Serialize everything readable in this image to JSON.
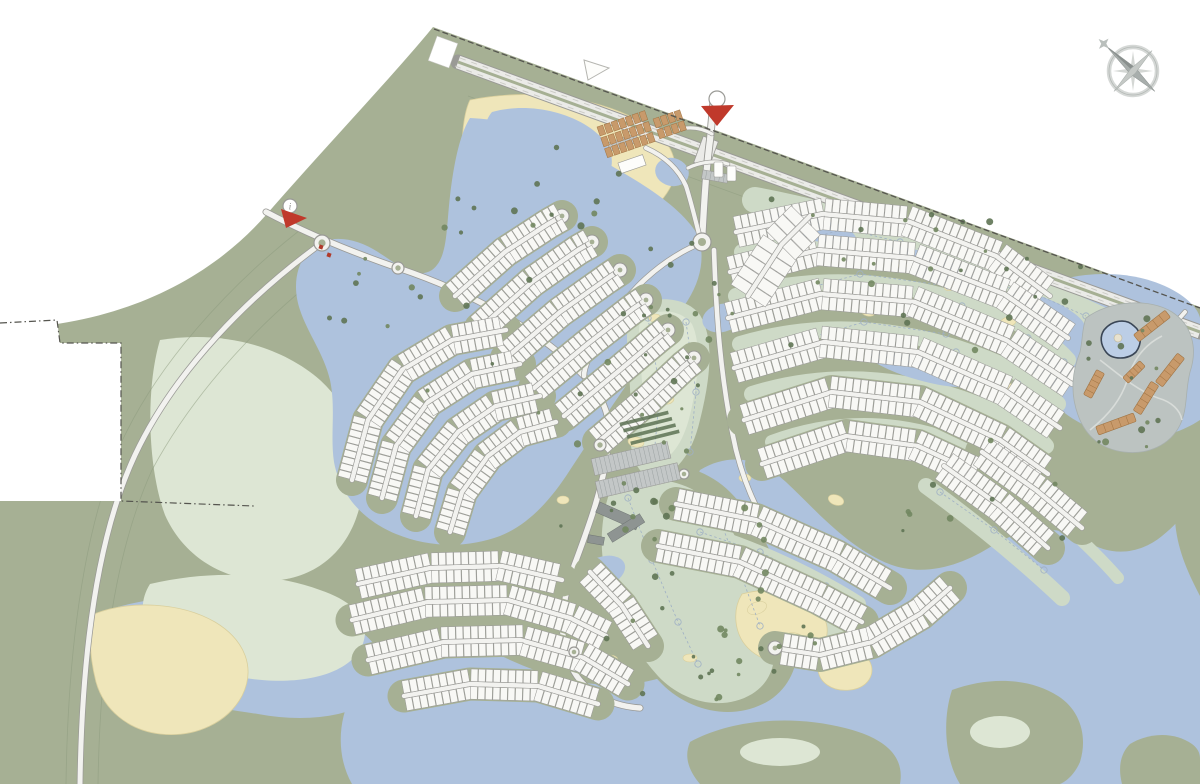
{
  "markers": {
    "info_label": "i"
  },
  "colors": {
    "background": "#ffffff",
    "land": "#a6b094",
    "land_contour": "#8d9a7e",
    "pale_green": "#cedac7",
    "pale_green_light": "#dde6d4",
    "water": "#aec2dd",
    "water_light": "#bccee6",
    "sand": "#efe6ba",
    "sand_stroke": "#d9cf9d",
    "plot_fill": "#f8f8f5",
    "plot_stroke": "#9b9b98",
    "road_fill": "#f2f2ef",
    "road_casing": "#9a9a96",
    "highway_fill": "#ebebe8",
    "building_orange": "#c89a6b",
    "building_orange_dark": "#a07342",
    "building_gray": "#8e9492",
    "parking_gray": "#c3c7c7",
    "resort_ground": "#bcc3c1",
    "tree_dark": "#5f7454",
    "tree_mid": "#728760",
    "marker_red": "#c0392b",
    "compass_gray": "#b3b8b5",
    "boundary": "#55554f",
    "hole_line": "#9fb0c5",
    "pool_dark": "#3a4656"
  },
  "map_data": {
    "strips": [
      {
        "id": "A1",
        "pts": [
          [
            455,
            296
          ],
          [
            505,
            252
          ],
          [
            548,
            224
          ],
          [
            562,
            216
          ]
        ],
        "depth": 12,
        "w": 7,
        "cul": true,
        "base": true
      },
      {
        "id": "A2",
        "pts": [
          [
            480,
            328
          ],
          [
            532,
            282
          ],
          [
            578,
            250
          ],
          [
            592,
            242
          ]
        ],
        "depth": 12,
        "w": 7,
        "cul": true,
        "base": true
      },
      {
        "id": "A3",
        "pts": [
          [
            506,
            358
          ],
          [
            560,
            312
          ],
          [
            608,
            278
          ],
          [
            620,
            270
          ]
        ],
        "depth": 12,
        "w": 7,
        "cul": true,
        "base": true
      },
      {
        "id": "A4",
        "pts": [
          [
            534,
            388
          ],
          [
            590,
            342
          ],
          [
            634,
            308
          ],
          [
            646,
            300
          ]
        ],
        "depth": 12,
        "w": 7,
        "cul": true,
        "base": true
      },
      {
        "id": "A5",
        "pts": [
          [
            564,
            416
          ],
          [
            620,
            370
          ],
          [
            658,
            338
          ],
          [
            668,
            330
          ]
        ],
        "depth": 12,
        "w": 7,
        "cul": true,
        "base": true
      },
      {
        "id": "A6",
        "pts": [
          [
            598,
            442
          ],
          [
            650,
            398
          ],
          [
            684,
            366
          ],
          [
            694,
            358
          ]
        ],
        "depth": 12,
        "w": 7,
        "cul": true,
        "base": true
      },
      {
        "id": "B1",
        "pts": [
          [
            352,
            480
          ],
          [
            368,
            420
          ],
          [
            402,
            370
          ],
          [
            452,
            340
          ],
          [
            506,
            330
          ]
        ],
        "depth": 12,
        "w": 7,
        "base": true
      },
      {
        "id": "B2",
        "pts": [
          [
            382,
            498
          ],
          [
            396,
            446
          ],
          [
            428,
            402
          ],
          [
            472,
            374
          ],
          [
            520,
            364
          ]
        ],
        "depth": 12,
        "w": 7,
        "base": true
      },
      {
        "id": "B3",
        "pts": [
          [
            416,
            516
          ],
          [
            428,
            470
          ],
          [
            458,
            432
          ],
          [
            496,
            406
          ],
          [
            540,
            396
          ]
        ],
        "depth": 12,
        "w": 7,
        "base": true
      },
      {
        "id": "B4",
        "pts": [
          [
            450,
            532
          ],
          [
            462,
            492
          ],
          [
            488,
            456
          ],
          [
            520,
            432
          ],
          [
            556,
            422
          ]
        ],
        "depth": 12,
        "w": 7,
        "base": true
      },
      {
        "id": "C1",
        "pts": [
          [
            358,
            584
          ],
          [
            430,
            568
          ],
          [
            502,
            566
          ],
          [
            562,
            580
          ]
        ],
        "depth": 12.5,
        "w": 7.5,
        "base": true
      },
      {
        "id": "C2",
        "pts": [
          [
            352,
            620
          ],
          [
            428,
            602
          ],
          [
            508,
            600
          ],
          [
            570,
            618
          ],
          [
            606,
            636
          ]
        ],
        "depth": 12.5,
        "w": 7.5,
        "base": true
      },
      {
        "id": "C3",
        "pts": [
          [
            368,
            660
          ],
          [
            444,
            642
          ],
          [
            520,
            640
          ],
          [
            584,
            658
          ],
          [
            628,
            684
          ]
        ],
        "depth": 12.5,
        "w": 7.5,
        "base": true
      },
      {
        "id": "C4",
        "pts": [
          [
            404,
            696
          ],
          [
            470,
            684
          ],
          [
            538,
            686
          ],
          [
            598,
            704
          ]
        ],
        "depth": 12.5,
        "w": 7.5,
        "base": true
      },
      {
        "id": "Cr",
        "pts": [
          [
            590,
            572
          ],
          [
            622,
            606
          ],
          [
            648,
            646
          ]
        ],
        "depth": 12,
        "w": 7.5,
        "base": true
      },
      {
        "id": "D1",
        "pts": [
          [
            736,
            232
          ],
          [
            822,
            214
          ],
          [
            910,
            222
          ],
          [
            996,
            256
          ],
          [
            1050,
            296
          ]
        ],
        "depth": 13,
        "w": 7.5
      },
      {
        "id": "D2",
        "pts": [
          [
            730,
            272
          ],
          [
            818,
            250
          ],
          [
            912,
            258
          ],
          [
            1004,
            294
          ],
          [
            1068,
            338
          ]
        ],
        "depth": 13,
        "w": 7.5
      },
      {
        "id": "D3",
        "pts": [
          [
            728,
            318
          ],
          [
            820,
            294
          ],
          [
            915,
            302
          ],
          [
            1006,
            340
          ],
          [
            1072,
            384
          ]
        ],
        "depth": 13,
        "w": 7.5
      },
      {
        "id": "D4",
        "pts": [
          [
            734,
            368
          ],
          [
            824,
            342
          ],
          [
            918,
            352
          ],
          [
            1004,
            390
          ],
          [
            1060,
            428
          ]
        ],
        "depth": 13,
        "w": 7.5
      },
      {
        "id": "D5",
        "pts": [
          [
            744,
            420
          ],
          [
            832,
            392
          ],
          [
            920,
            402
          ],
          [
            1000,
            440
          ],
          [
            1048,
            474
          ]
        ],
        "depth": 13,
        "w": 7.5,
        "base": true
      },
      {
        "id": "D6",
        "pts": [
          [
            762,
            464
          ],
          [
            846,
            436
          ],
          [
            918,
            446
          ],
          [
            978,
            474
          ]
        ],
        "depth": 13,
        "w": 7.5,
        "base": true
      },
      {
        "id": "BP",
        "pts": [
          [
            748,
            296
          ],
          [
            782,
            244
          ],
          [
            810,
            216
          ]
        ],
        "depth": 18,
        "w": 12
      },
      {
        "id": "E1",
        "pts": [
          [
            676,
            504
          ],
          [
            756,
            520
          ],
          [
            836,
            556
          ],
          [
            890,
            588
          ]
        ],
        "depth": 13,
        "w": 7.5,
        "base": true
      },
      {
        "id": "E2",
        "pts": [
          [
            658,
            546
          ],
          [
            740,
            562
          ],
          [
            818,
            598
          ],
          [
            862,
            622
          ]
        ],
        "depth": 13,
        "w": 7.5,
        "base": true
      },
      {
        "id": "E3",
        "pts": [
          [
            950,
            588
          ],
          [
            920,
            614
          ],
          [
            872,
            642
          ],
          [
            820,
            655
          ],
          [
            775,
            648
          ]
        ],
        "depth": 13,
        "w": 7.5,
        "cul": true,
        "base": true
      },
      {
        "id": "E5",
        "pts": [
          [
            944,
            466
          ],
          [
            1000,
            506
          ],
          [
            1048,
            548
          ]
        ],
        "depth": 13,
        "w": 7.5,
        "base": true
      },
      {
        "id": "E6",
        "pts": [
          [
            982,
            452
          ],
          [
            1036,
            490
          ],
          [
            1082,
            528
          ]
        ],
        "depth": 13,
        "w": 7.5,
        "base": true
      }
    ],
    "trees": [
      [
        620,
        305,
        90,
        170,
        13
      ],
      [
        605,
        480,
        170,
        215,
        24
      ],
      [
        740,
        245,
        330,
        115,
        14
      ],
      [
        765,
        192,
        330,
        85,
        11
      ],
      [
        1082,
        305,
        115,
        145,
        13
      ],
      [
        480,
        105,
        185,
        125,
        9
      ],
      [
        640,
        235,
        110,
        115,
        9
      ],
      [
        380,
        275,
        230,
        150,
        10
      ],
      [
        700,
        565,
        120,
        135,
        11
      ],
      [
        900,
        435,
        180,
        135,
        9
      ],
      [
        560,
        435,
        110,
        100,
        7
      ],
      [
        300,
        255,
        90,
        75,
        5
      ],
      [
        420,
        180,
        60,
        60,
        4
      ]
    ],
    "bunkers": [
      [
        648,
        352,
        7,
        4,
        20
      ],
      [
        668,
        400,
        6,
        4,
        -15
      ],
      [
        636,
        442,
        8,
        5,
        10
      ],
      [
        700,
        518,
        8,
        5,
        0
      ],
      [
        733,
        562,
        9,
        5,
        30
      ],
      [
        757,
        608,
        10,
        6,
        -20
      ],
      [
        795,
        638,
        9,
        5,
        15
      ],
      [
        690,
        658,
        7,
        4,
        0
      ],
      [
        905,
        262,
        9,
        5,
        -18
      ],
      [
        952,
        286,
        8,
        4,
        -18
      ],
      [
        868,
        312,
        7,
        4,
        12
      ],
      [
        1008,
        322,
        9,
        5,
        -20
      ],
      [
        930,
        362,
        7,
        4,
        0
      ],
      [
        976,
        428,
        8,
        5,
        -25
      ],
      [
        1032,
        452,
        7,
        4,
        -30
      ],
      [
        836,
        500,
        8,
        5,
        20
      ],
      [
        806,
        250,
        7,
        4,
        -15
      ],
      [
        1114,
        338,
        8,
        5,
        0
      ],
      [
        655,
        318,
        6,
        4,
        0
      ],
      [
        745,
        478,
        6,
        4,
        0
      ],
      [
        563,
        500,
        6,
        4,
        0
      ],
      [
        610,
        660,
        8,
        5,
        0
      ],
      [
        878,
        452,
        6,
        4,
        -20
      ],
      [
        1010,
        388,
        6,
        4,
        -15
      ]
    ],
    "roundabouts": [
      [
        702,
        242,
        9
      ],
      [
        322,
        243,
        8
      ],
      [
        398,
        268,
        6
      ],
      [
        600,
        445,
        6
      ],
      [
        684,
        474,
        5
      ],
      [
        574,
        652,
        5
      ]
    ],
    "hole_lines": [
      [
        [
          648,
          318
        ],
        [
          660,
          390
        ],
        [
          654,
          456
        ]
      ],
      [
        [
          686,
          322
        ],
        [
          696,
          392
        ],
        [
          690,
          452
        ]
      ],
      [
        [
          628,
          498
        ],
        [
          652,
          560
        ],
        [
          678,
          622
        ],
        [
          698,
          664
        ]
      ],
      [
        [
          716,
          510
        ],
        [
          740,
          572
        ],
        [
          760,
          626
        ]
      ],
      [
        [
          762,
          250
        ],
        [
          850,
          228
        ],
        [
          936,
          240
        ]
      ],
      [
        [
          954,
          262
        ],
        [
          1018,
          292
        ],
        [
          1056,
          318
        ]
      ],
      [
        [
          772,
          298
        ],
        [
          860,
          274
        ],
        [
          948,
          286
        ]
      ],
      [
        [
          962,
          306
        ],
        [
          1028,
          338
        ],
        [
          1064,
          362
        ]
      ],
      [
        [
          782,
          346
        ],
        [
          864,
          322
        ],
        [
          946,
          334
        ]
      ],
      [
        [
          956,
          352
        ],
        [
          1018,
          384
        ],
        [
          1050,
          408
        ]
      ],
      [
        [
          792,
          216
        ],
        [
          900,
          242
        ],
        [
          1008,
          282
        ],
        [
          1086,
          316
        ]
      ],
      [
        [
          700,
          532
        ],
        [
          760,
          552
        ],
        [
          826,
          586
        ]
      ],
      [
        [
          940,
          492
        ],
        [
          994,
          530
        ],
        [
          1044,
          570
        ]
      ]
    ],
    "resort_buildings": [
      [
        1152,
        326,
        40,
        9,
        -38
      ],
      [
        1170,
        370,
        36,
        9,
        -52
      ],
      [
        1146,
        398,
        34,
        9,
        -58
      ],
      [
        1116,
        424,
        40,
        9,
        -20
      ],
      [
        1094,
        384,
        28,
        9,
        -62
      ],
      [
        1134,
        372,
        24,
        8,
        -45
      ]
    ],
    "marina_blocks": [
      {
        "x": 597,
        "y": 127,
        "rot": -19,
        "rows": 3,
        "cols": 7
      },
      {
        "x": 653,
        "y": 119,
        "rot": -19,
        "rows": 2,
        "cols": 4
      }
    ],
    "parking_lots": [
      {
        "x": 592,
        "y": 450,
        "w": 78,
        "h": 17,
        "rot": -13
      },
      {
        "x": 596,
        "y": 472,
        "w": 84,
        "h": 17,
        "rot": -13
      },
      {
        "x": 608,
        "y": 138,
        "w": 30,
        "h": 9,
        "rot": -19
      },
      {
        "x": 702,
        "y": 172,
        "w": 26,
        "h": 9,
        "rot": 10
      }
    ]
  }
}
